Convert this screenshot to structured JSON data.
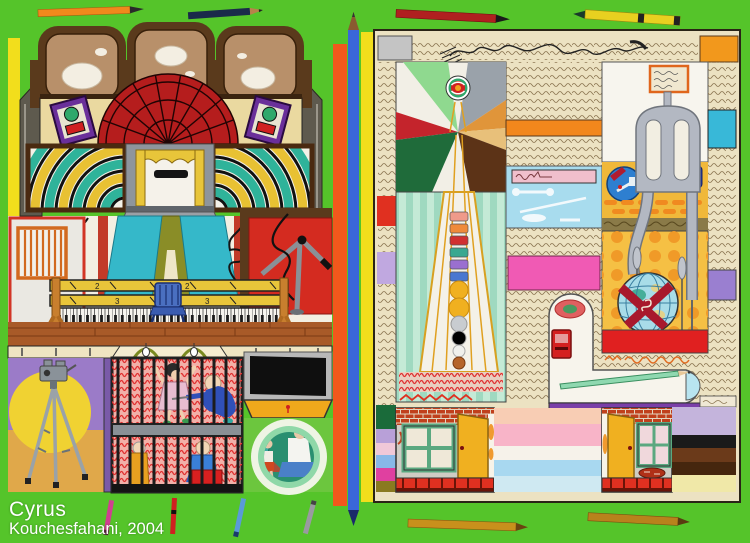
{
  "artwork": {
    "caption": {
      "line1": "Cyrus",
      "line2": "Kouchesfahani, 2004"
    }
  },
  "left_panel": {
    "piano": {
      "rail_mark_top": "2",
      "rail_mark_bottom": "3"
    },
    "objects": [
      "ceiling-panels",
      "wall-speakers",
      "brick-dome",
      "striped-arcs",
      "stage-with-curtain",
      "mail-slot",
      "teal-curtains",
      "barred-window",
      "boom-arm",
      "piano-keyboard",
      "blue-chair",
      "wood-floor",
      "camera-on-tripod",
      "spotlight-sun",
      "cage-with-children",
      "black-screen",
      "photographers-in-circle"
    ]
  },
  "right_panel": {
    "objects": [
      "handwriting-texture",
      "ray-tower",
      "beacon-ball",
      "color-chips",
      "pool-panel",
      "magenta-panel",
      "abstract-figure",
      "signboard",
      "eye-disc",
      "hanging-globe",
      "cattail-pins",
      "pencil-sharpener",
      "green-pencil",
      "purple-bar",
      "house-facade",
      "windows",
      "open-doors",
      "color-stripe-columns"
    ]
  },
  "pencils": {
    "top": [
      "orange",
      "navy",
      "red",
      "yellow"
    ],
    "divider": [
      "blue"
    ],
    "bottom": [
      "magenta",
      "red",
      "light-blue",
      "gray",
      "gold",
      "gold"
    ]
  },
  "palette": {
    "background_green": "#55c42a",
    "panel_cream": "#ece2c2",
    "divider_orange": "#f2581c",
    "divider_blue": "#3a66d8",
    "edge_yellow": "#f2de1c",
    "brick_red": "#b51d1d",
    "curtain_teal": "#35b8c9",
    "cage_red": "#e03030",
    "sun_yellow": "#f0d232",
    "figure_gray": "#b3b8c2"
  }
}
